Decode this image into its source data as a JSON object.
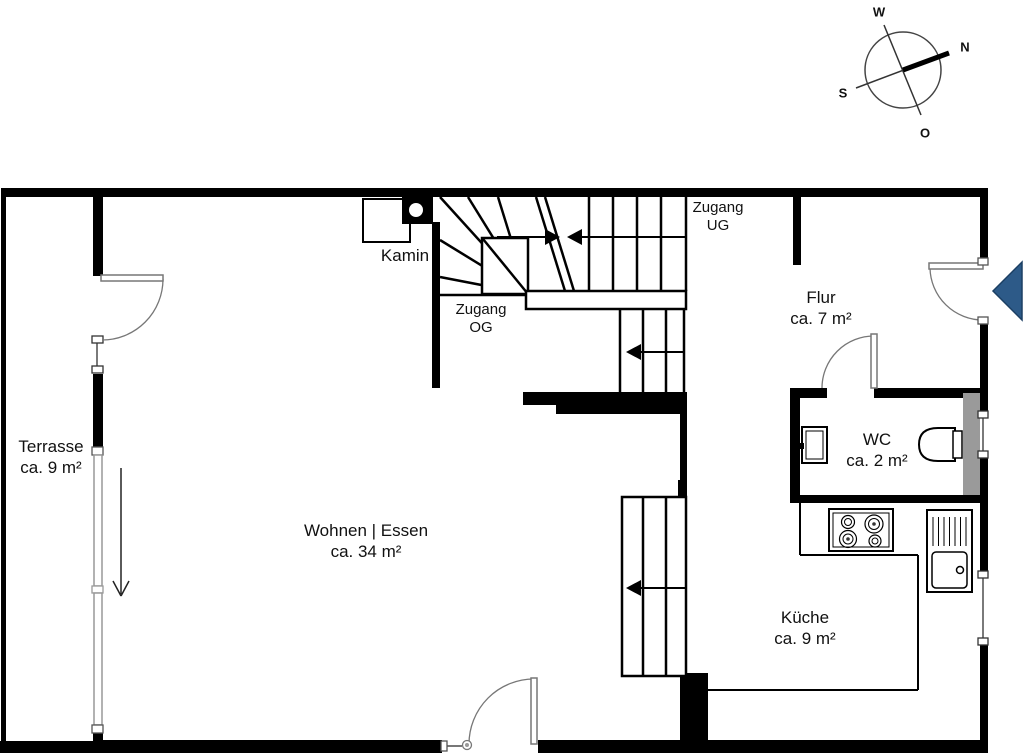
{
  "plan": {
    "title": "Grundriss Erdgeschoss",
    "rooms": {
      "terrasse": {
        "name": "Terrasse",
        "area": "ca. 9 m²"
      },
      "wohnen": {
        "name": "Wohnen | Essen",
        "area": "ca. 34 m²"
      },
      "flur": {
        "name": "Flur",
        "area": "ca. 7 m²"
      },
      "wc": {
        "name": "WC",
        "area": "ca. 2 m²"
      },
      "kueche": {
        "name": "Küche",
        "area": "ca. 9 m²"
      }
    },
    "fireplace_label": "Kamin",
    "stairs": {
      "zugang_og": {
        "line1": "Zugang",
        "line2": "OG"
      },
      "zugang_ug": {
        "line1": "Zugang",
        "line2": "UG"
      }
    }
  },
  "compass": {
    "west": "W",
    "north": "N",
    "south": "S",
    "east": "O"
  },
  "colors": {
    "wall": "#000000",
    "entrance_arrow_fill": "#2d5a88",
    "entrance_arrow_border": "#1b3f63",
    "shaft_gray": "#9a9a9a"
  }
}
